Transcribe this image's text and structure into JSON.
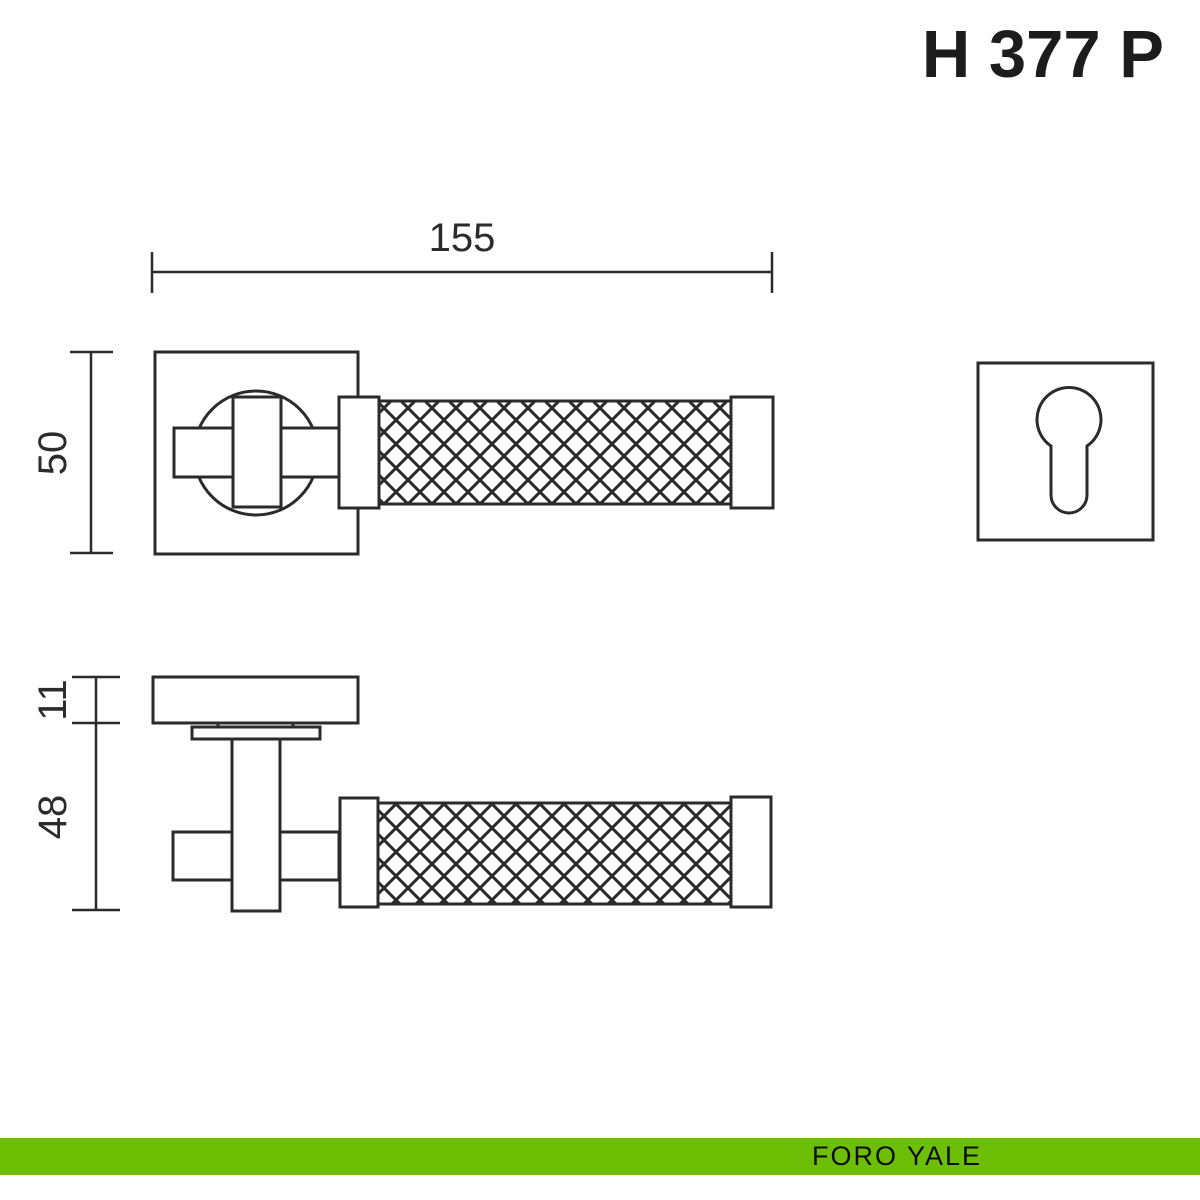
{
  "title": "H 377 P",
  "dimensions": {
    "handle_length": "155",
    "rosette_size": "50",
    "rosette_thickness": "11",
    "handle_depth": "48"
  },
  "footer": {
    "label": "FORO YALE",
    "bar_color": "#6cbf05"
  },
  "drawing": {
    "line_color": "#2b2b2b"
  }
}
